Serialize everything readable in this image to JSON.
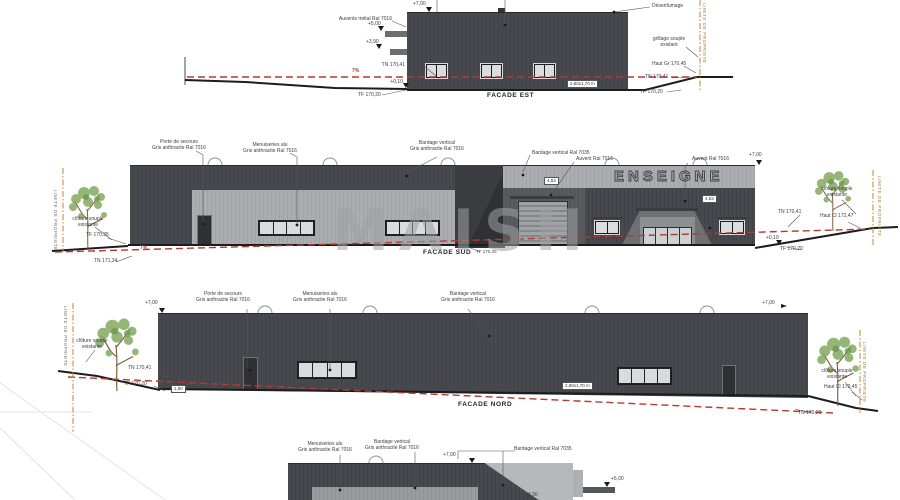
{
  "common": {
    "limite": "LIMITE DE PROPRIETE",
    "slope": "7%"
  },
  "watermark": {
    "text": "MAISH"
  },
  "colors": {
    "facade_dark": "#46484d",
    "facade_light": "#a7a9ac",
    "grade_line_red": "#b5392e",
    "property_line_orange": "#c08a2f",
    "ground_line": "#1c1c1c"
  },
  "facade_est": {
    "title": "FACADE EST",
    "labels": {
      "auvents": "Auvents métal Ral 7016",
      "desenfumage": "Désenfumage",
      "level_700": "+7,00",
      "level_500": "+5,00",
      "level_390": "+3,90",
      "level_010": "+0,10",
      "tn_left": "TN 170,41",
      "tf_left": "TF 170,20",
      "grillage": "grillage souple\nexistant",
      "haut_right": "Haut Gr 170,45",
      "tn_right": "TN 170,41",
      "tf_right": "TF 170,20",
      "dim_box": "2,80x1,70 m"
    }
  },
  "facade_sud": {
    "title": "FACADE SUD",
    "enseigne": "ENSEIGNE",
    "labels": {
      "porte": "Porte de secours\nGris anthracite Ral 7016",
      "menuiseries": "Menuiseries alu\nGris anthracite Ral 7016",
      "bardage_7016": "Bardage vertical\nGris anthracite Ral 7016",
      "bardage_7035": "Bardage vertical Ral 7035",
      "auvent_1": "Auvent Ral 7016",
      "auvent_2": "Auvent Ral 7016",
      "level_700": "+7,00",
      "level_010": "+0,10",
      "cloture_left": "clôture souple\nexistante",
      "tf_left": "TF 170,35",
      "tn_bottom_left": "TN 171,34",
      "tn_right": "TN 170,41",
      "tf_right": "TF 170,20",
      "cloture_right": "clôture souple\nexistante",
      "haut_right": "Haut Cl 172,47",
      "dim_1": "4,53",
      "dim_2": "4,53",
      "tf_title": "TF 170,20"
    }
  },
  "facade_nord": {
    "title": "FACADE NORD",
    "labels": {
      "porte": "Porte de secours\nGris anthracite Ral 7016",
      "menuiseries": "Menuiseries alu\nGris anthracite Ral 7016",
      "bardage_7016": "Bardage vertical\nGris anthracite Ral 7016",
      "level_700_left": "+7,00",
      "level_700_right": "+7,00",
      "cloture_left": "clôture souple\nexistante",
      "tn_left": "TN 170,41",
      "tf_left": "TF 170,20",
      "cloture_right": "clôture souple\nexistante",
      "haut_right": "Haut Cl 170,45",
      "tn_right": "TN 170,20",
      "dim_box": "2,80x1,70 m",
      "dim_small": "1,80"
    }
  },
  "facade_ouest": {
    "labels": {
      "menuiseries": "Menuiseries alu\nGris anthracite Ral 7016",
      "bardage_7016": "Bardage vertical\nGris anthracite Ral 7016",
      "bardage_7035": "Bardage vertical Ral 7035",
      "level_700": "+7,00",
      "level_500": "+5,00",
      "level_490": "+4,90"
    }
  }
}
